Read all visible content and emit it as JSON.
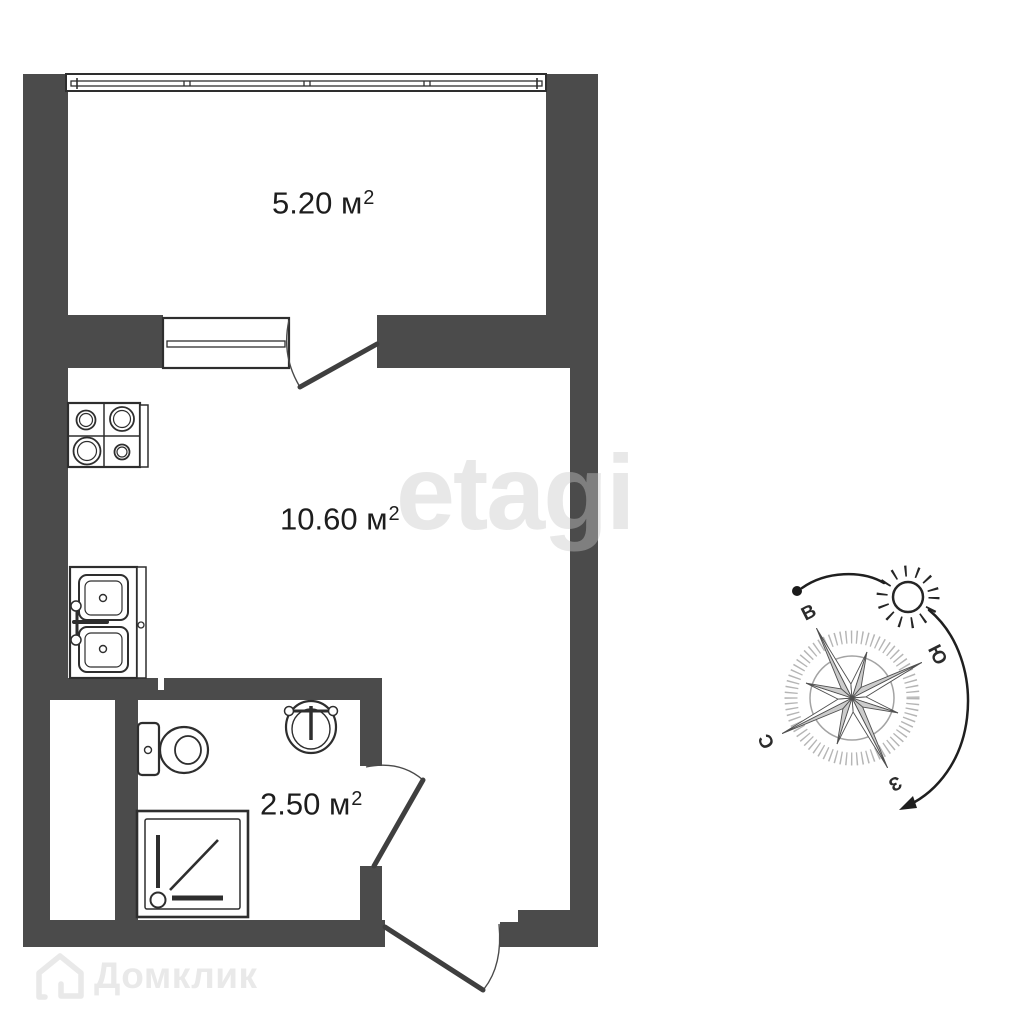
{
  "rooms": [
    {
      "id": "balcony",
      "label": "5.20 м",
      "sup": "2"
    },
    {
      "id": "living",
      "label": "10.60 м",
      "sup": "2"
    },
    {
      "id": "bathroom",
      "label": "2.50 м",
      "sup": "2"
    }
  ],
  "compass": {
    "east": "В",
    "south": "Ю",
    "north": "С",
    "west": "З"
  },
  "watermarks": {
    "center": "etagi",
    "bottom": "Домклик"
  },
  "colors": {
    "wall": "#4b4b4b",
    "line": "#2e2e2e",
    "compass_tick": "#b5b5b5",
    "star_fill": "#cccccc",
    "text": "#1d1d1d",
    "watermark": "#e9e9e9"
  }
}
